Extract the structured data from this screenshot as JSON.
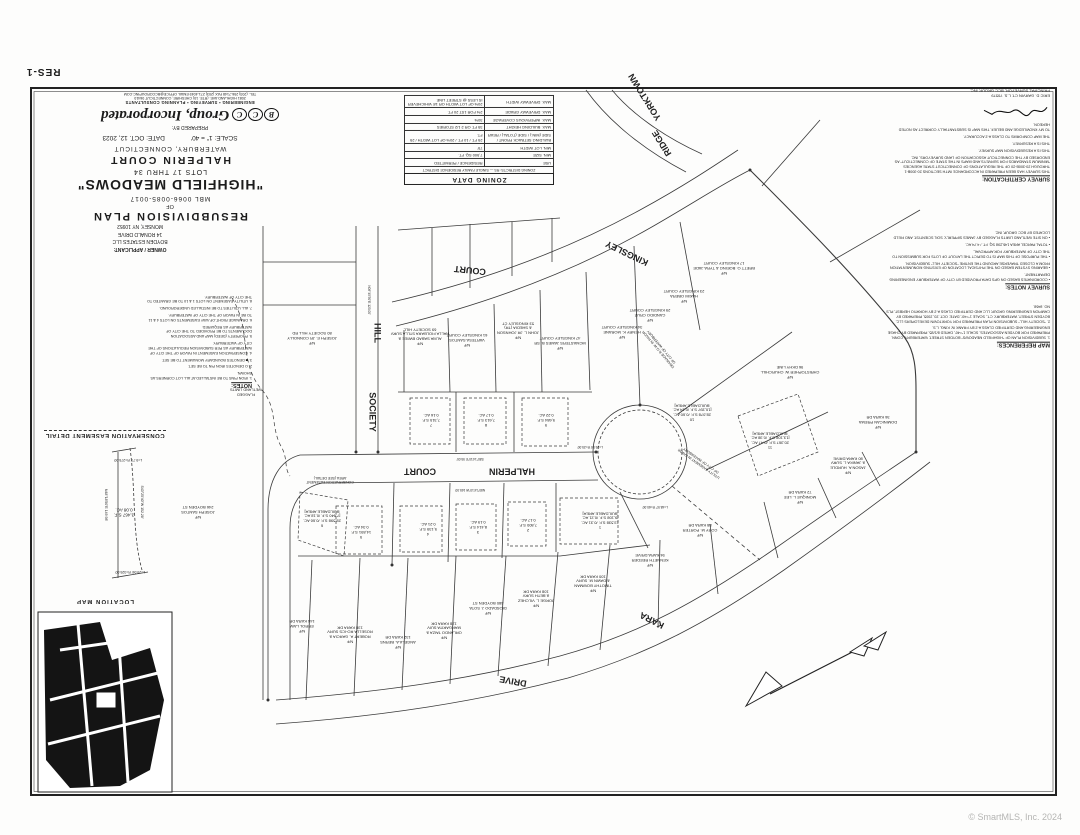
{
  "sheet": {
    "number": "RES-1",
    "copyright": "© SmartMLS, Inc. 2024"
  },
  "prepared_by": {
    "label": "PREPARED BY:",
    "logo_letters": [
      "B",
      "C",
      "C"
    ],
    "firm_name": "Group, Incorporated",
    "firm_line": "ENGINEERING • SURVEYING • PLANNING CONSULTANTS",
    "address_line": "2081 HIGHLAND AVE. (RTE. 10) CHESHIRE, CONNECTICUT 06410",
    "contact_line": "TEL. (203) 256-7148  FAX (203) 271-4049  EMAIL OFFICE@BCCGROUPINC.COM"
  },
  "title_block": {
    "plan_type": "RESUBDIVISION PLAN",
    "of": "OF",
    "mbl": "MBL 0066-0085-0017",
    "name": "\"HIGHFIELD MEADOWS\"",
    "lots": "LOTS 17 THRU 34",
    "street": "HALPERIN COURT",
    "city": "WATERBURY, CONNECTICUT",
    "scale": "SCALE: 1\" = 40'",
    "date": "DATE: OCT. 12, 2023"
  },
  "owner": {
    "label": "OWNER / APPLICANT:",
    "name": "BOYDEN ESTATES LLC",
    "address1": "14 RONALD DRIVE",
    "address2": "MONSEY, NY 10952"
  },
  "zoning": {
    "title": "ZONING DATA",
    "district": "ZONING DISTRICTS: RS — SINGLE FAMILY RESIDENCE DISTRICT",
    "rows": [
      {
        "label": "USE",
        "value": "RESIDENCE / PERMITTED"
      },
      {
        "label": "MIN. SIZE",
        "value": "7,500 SQ. FT."
      },
      {
        "label": "MIN. LOT WIDTH",
        "value": "75'"
      },
      {
        "label": "BUILDING SETBACK FRONT / SIDE (MIN.) / SIDE (TOTAL) / REAR",
        "value": "25 FT. / 10 FT. / 20% OF LOT WIDTH / 25 FT."
      },
      {
        "label": "MAX. BUILDING HEIGHT",
        "value": "35 FT. OR 2 1/2 STORIES"
      },
      {
        "label": "MAX. IMPERVIOUS COVERAGE",
        "value": "30%"
      },
      {
        "label": "MAX. DRIVEWAY GRADE",
        "value": "2% FOR 1ST 20 FT."
      },
      {
        "label": "MAX. DRIVEWAY WIDTH",
        "value": "20% OF LOT WIDTH OR 18' WHICHEVER IS LESS @ STREET LINE"
      }
    ]
  },
  "certification": {
    "title": "SURVEY CERTIFICATION:",
    "lines": [
      "THIS SURVEY HAS BEEN PREPARED IN ACCORDANCE WITH SECTIONS 20-300B-1 THROUGH 20-300B-20 OF THE REGULATIONS OF CONNECTICUT STATE AGENCIES \"MINIMUM STANDARDS FOR SURVEYS AND MAPS IN THE STATE OF CONNECTICUT\" AS ENDORSED BY THE CONNECTICUT ASSOCIATION OF LAND SURVEYORS, INC.",
      "THIS IS A RESUBDIVISION MAP SURVEY.",
      "THIS IS A RESURVEY.",
      "THE MAP CONFORMS TO CLASS A-2 ACCURACY.",
      "TO MY KNOWLEDGE AND BELIEF, THIS MAP IS SUBSTANTIALLY CORRECT AS NOTED HEREON."
    ],
    "signer": "ERIC D. GARVIN    CT. L.S. 70579",
    "signer_title": "PRINCIPAL SURVEYOR, BCC GROUP, INC."
  },
  "survey_notes": {
    "title": "SURVEY NOTES:",
    "items": [
      "COORDINATES BASED ON GPS DATA PROVIDED BY CITY OF WATERBURY ENGINEERING DEPARTMENT.",
      "BEARING SYSTEM BASED ON THE PHYSICAL LOCATION OF EXISTING MONUMENTATION FROM A CLOSED TRAVERSE AROUND THE ENTIRE \"SOCIETY HILL\" SUBDIVISION.",
      "THE PURPOSE OF THIS MAP IS TO DEPICT THE LAYOUT OF LOTS FOR SUBMISSION TO THE CITY OF WATERBURY FOR APPROVAL.",
      "TOTAL PARCEL AREA 146,298 SQ. FT. / 4.74 AC.",
      "ON SITE WETLAND LIMITS FLAGGED BY JAMES SIPPERLY, SOIL SCIENTIST, AND FIELD LOCATED BY BCC GROUP, INC."
    ]
  },
  "map_references": {
    "title": "MAP REFERENCES:",
    "items": [
      "1. SUBDIVISION PLAN OF \"HIGHFIELD MEADOWS\" BOYDEN STREET, WATERBURY, CONN. PREPARED FOR BOYDEN ASSOCIATES, SCALE 1\"=40', DATED 8/1/85, PREPARED BY CHASE ENGINEERING AND CERTIFIED CLASS A-2 BY FRANK W. KING, L.S.",
      "2. \"SOCIETY HILL\" SUBDIVISION PLAN PREPARED FOR YORKTOWN DEVELOPERS LLC, BOYDEN STREET, WATERBURY, CT., SCALE 1\"=40', DATE: OCT. 20, 2005, PREPARED BY CAMPION ENGINEERING GROUP, LLC AND CERTIFIED CLASS A-2 BY HORATIO HERBST, PLS NO. 8468."
    ]
  },
  "notes": {
    "title": "NOTES:",
    "items": [
      "1. IRON PINS TO BE INSTALLED AT ALL LOT CORNERS AS SHOWN.",
      "2. O DENOTES IRON PIN TO BE SET.",
      "3. ■ DENOTES BOUNDARY MONUMENT TO BE SET.",
      "4. CONSERVATION EASEMENT IN FAVOR OF THE CITY OF WATERBURY AS PER SUBDIVISION REGULATIONS OF THE CITY OF WATERBURY.",
      "5. PROPERTY (DEED) MAP AND ASSOCIATION DOCUMENTS TO BE PROVIDED TO THE CITY OF WATERBURY AS REQUIRED.",
      "6. DRAINAGE RIGHT-OF-WAY EASEMENTS ON LOTS 4 & 11 TO BE IN FAVOR OF THE CITY OF WATERBURY.",
      "7. ALL UTILITIES TO BE INSTALLED UNDERGROUND.",
      "8. UTILITY EASEMENT ON LOTS 1 & 10 TO BE GRANTED TO THE CITY OF WATERBURY."
    ]
  },
  "conservation_detail": {
    "title": "CONSERVATION EASEMENT DETAIL"
  },
  "location_map": {
    "title": "LOCATION MAP"
  },
  "north_arrow": {
    "label": "N"
  },
  "map": {
    "labels": [
      {
        "t": "HILL",
        "x": 377,
        "y": 333,
        "r": 90,
        "s": 9,
        "b": true
      },
      {
        "t": "SOCIETY",
        "x": 372,
        "y": 412,
        "r": 90,
        "s": 9,
        "b": true
      },
      {
        "t": "COURT",
        "x": 470,
        "y": 270,
        "r": 186,
        "s": 9,
        "b": true
      },
      {
        "t": "KINGSLEY",
        "x": 627,
        "y": 253,
        "r": 206,
        "s": 9,
        "b": true
      },
      {
        "t": "YORKTOWN",
        "x": 645,
        "y": 97,
        "r": 238,
        "s": 9,
        "b": true
      },
      {
        "t": "RIDGE",
        "x": 662,
        "y": 143,
        "r": 238,
        "s": 9,
        "b": true
      },
      {
        "t": "HALPERIN",
        "x": 512,
        "y": 471,
        "r": 180,
        "s": 9,
        "b": true
      },
      {
        "t": "COURT",
        "x": 420,
        "y": 471,
        "r": 180,
        "s": 9,
        "b": true
      },
      {
        "t": "KARA",
        "x": 652,
        "y": 620,
        "r": 207,
        "s": 9,
        "b": true
      },
      {
        "t": "DRIVE",
        "x": 513,
        "y": 681,
        "r": 190,
        "s": 9,
        "b": true
      },
      {
        "t": "1\n13,538 S.F. /0.31 AC.\n[9,108 S.F. /0.21 AC.\nBUILDABLE AREA]",
        "x": 600,
        "y": 520
      },
      {
        "t": "2\n7,800 S.F.\n0.17 AC.",
        "x": 528,
        "y": 525
      },
      {
        "t": "3\n8,414 S.F.\n0.19 AC.",
        "x": 478,
        "y": 527
      },
      {
        "t": "4\n9,139 S.F.\n0.21 AC.",
        "x": 428,
        "y": 529
      },
      {
        "t": "5\n14,891 S.F.\n0.34 AC.",
        "x": 361,
        "y": 532
      },
      {
        "t": "6\n28,598 S.F. /0.66 AC.\n[7,840 S.F. /0.18 AC.\nBUILDABLE AREA]",
        "x": 322,
        "y": 518
      },
      {
        "t": "7\n7,315 S.F.\n0.16 AC.",
        "x": 431,
        "y": 420
      },
      {
        "t": "8\n7,613 S.F.\n0.17 AC.",
        "x": 486,
        "y": 420
      },
      {
        "t": "9\n9,684 S.F.\n0.22 AC.",
        "x": 546,
        "y": 420
      },
      {
        "t": "10\n28,078 S.F. /0.60 AC.\n[10,397 S.F. /0.24 AC.\nBUILDABLE AREA]",
        "x": 692,
        "y": 412
      },
      {
        "t": "11\n20,367 S.F. /0.47 AC.\n[13,108 S.F. /0.38 AC.\nBUILDABLE AREA]",
        "x": 770,
        "y": 440
      },
      {
        "t": "N/F\nJOSEPH E. JR CONNOLLY\n80 SOCIETY HILL RD",
        "x": 312,
        "y": 338
      },
      {
        "t": "N/F\nALMA SABAD BWIEE &\nHALLA FIOLBARA STLLA SURV\n69 SOCIETY HILL",
        "x": 420,
        "y": 336
      },
      {
        "t": "N/F\nVARTESA SANTOS\n61 KINGSLEY COURT",
        "x": 467,
        "y": 340
      },
      {
        "t": "N/F\nJOHN L. JR JOHNSON\n& SHEDIA (TR)\n53 KINGSLEY CT",
        "x": 518,
        "y": 330
      },
      {
        "t": "N/F\nMCMASTERS JAMES B. SR\n47 KINGSLEY COURT",
        "x": 560,
        "y": 343
      },
      {
        "t": "N/F\nHENRY K. MORANE\n34 KINGSLEY COURT",
        "x": 622,
        "y": 332
      },
      {
        "t": "N/F\nCANDIDO CRUZ\n29 KINGSLEY COURT",
        "x": 650,
        "y": 315
      },
      {
        "t": "N/F\nHAKIM OBERA\n23 KINGSLEY COURT",
        "x": 684,
        "y": 296
      },
      {
        "t": "N/F\nBRETT O. BOEING & TYRA JADE\n17 KINGSLEY COURT",
        "x": 724,
        "y": 268
      },
      {
        "t": "N/F\nCHRISTOPHER W. CHURCHILL\n96 DKHY LINE",
        "x": 790,
        "y": 372
      },
      {
        "t": "N/F\nERROL LAW\n144 KARA DR",
        "x": 302,
        "y": 626
      },
      {
        "t": "N/F\nROBERT A. GARCIA &\nROSELLA RO-ICS SURV\n138 KARA DR",
        "x": 350,
        "y": 634
      },
      {
        "t": "N/F\nANGELA A. BERNS\n132 KARA DR",
        "x": 398,
        "y": 642
      },
      {
        "t": "N/F\nORLANDO TAIZA &\nMARGARITA SUIV\n128 KARA DR",
        "x": 444,
        "y": 630
      },
      {
        "t": "N/F\nDIOSDADO J. SOTA\n480 BOYDEN ST",
        "x": 488,
        "y": 608
      },
      {
        "t": "N/F\nJORGE L. VILCHEZ\n& BETH SURV\n108 KARA DR",
        "x": 536,
        "y": 598
      },
      {
        "t": "N/F\nTIMOTHY BOWMAN\n& DAWN M. SURV\n100 KARA DR",
        "x": 593,
        "y": 583
      },
      {
        "t": "N/F\nKENNETH REEDER\n94 KARA DRIVE",
        "x": 650,
        "y": 560
      },
      {
        "t": "N/F\nCORY M. PORTER\n88 KARA DR",
        "x": 700,
        "y": 530
      },
      {
        "t": "N/F\nMONIQUE L. LEE\n72 KARA DR",
        "x": 800,
        "y": 497
      },
      {
        "t": "N/F\nJASON A. HURDLE\n& JANIKA L. SURV\n80 KARA DRIVE",
        "x": 848,
        "y": 465
      },
      {
        "t": "N/F\nDOMINICAN PREMA\n36 KARA DR",
        "x": 878,
        "y": 422
      },
      {
        "t": "N/F\nJOSEPH SANTOS\n246 BOYDEN ST",
        "x": 198,
        "y": 512
      },
      {
        "t": "FLAGGED\nWETLAND LIMITS",
        "x": 246,
        "y": 392,
        "s": 3.8
      },
      {
        "t": "UTILITY EASEMENT IN FAVOR\nOF CITY OF WATERBURY",
        "x": 700,
        "y": 462,
        "r": 215,
        "s": 3.5
      },
      {
        "t": "DRAINAGE R.O.W. IN FAVOR\nOF CITY OF WATERBURY",
        "x": 660,
        "y": 348,
        "r": 230,
        "s": 3.5
      },
      {
        "t": "CONSERVATION EASEMENT\nAREA (SEE DETAIL)",
        "x": 330,
        "y": 480,
        "s": 3.5
      },
      {
        "t": "3,467 S.F.\n0.08 AC.",
        "x": 124,
        "y": 512,
        "s": 4.5
      },
      {
        "t": "N48°18'50\"E  149.98'",
        "x": 106,
        "y": 505,
        "r": 90,
        "s": 3.5
      },
      {
        "t": "S43°25'40\"W  152.28'",
        "x": 142,
        "y": 502,
        "r": 90,
        "s": 3.5
      },
      {
        "t": "L=29.06'  R=325.00'",
        "x": 130,
        "y": 572,
        "s": 3.5
      },
      {
        "t": "L=9.77'  R=275.00'",
        "x": 128,
        "y": 460,
        "s": 3.5
      },
      {
        "t": "S80°14'10\"E  95.00'",
        "x": 470,
        "y": 458,
        "s": 3.2
      },
      {
        "t": "N80°14'10\"W  165.00'",
        "x": 470,
        "y": 489,
        "s": 3.2
      },
      {
        "t": "N09°45'50\"E  120.00'",
        "x": 368,
        "y": 300,
        "r": 90,
        "s": 3.2
      },
      {
        "t": "L=48.97'  R=60.00'",
        "x": 655,
        "y": 506,
        "s": 3.2
      },
      {
        "t": "L=29.54'  R=25.00'",
        "x": 590,
        "y": 446,
        "s": 3.2
      }
    ]
  }
}
